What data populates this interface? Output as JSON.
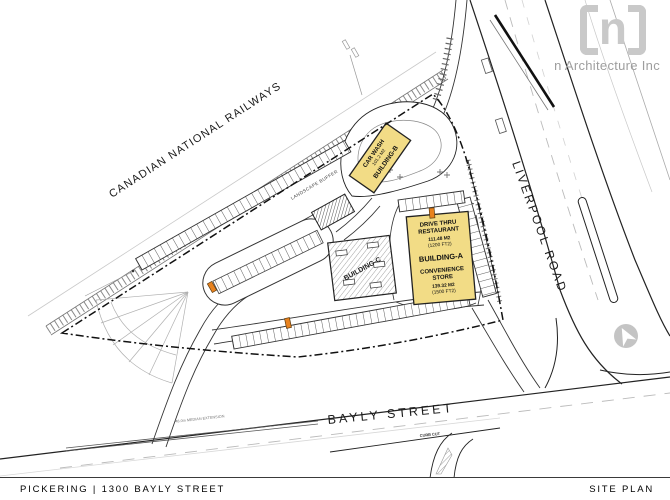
{
  "logo": {
    "mark_letter": "n",
    "company": "n Architecture Inc"
  },
  "title_block": {
    "project": "PICKERING | 1300 BAYLY STREET",
    "sheet": "SITE PLAN"
  },
  "map_labels": {
    "railway": "CANADIAN NATIONAL RAILWAYS",
    "landscape_buffer": "LANDSCAPE BUFFER",
    "liverpool_road": "LIVERPOOL ROAD",
    "bayly_street": "BAYLY STREET",
    "median_extension": "48.0m MEDIAN EXTENSION",
    "curb_cut": "CURB CUT"
  },
  "buildings": {
    "building_a": {
      "use_1": "DRIVE THRU",
      "use_1b": "RESTAURANT",
      "area_1": "111.48 M2",
      "area_1_ft": "(1200 FT2)",
      "name": "BUILDING-A",
      "use_2": "CONVENIENCE",
      "use_2b": "STORE",
      "area_2": "139.32 M2",
      "area_2_ft": "(1500 FT2)"
    },
    "building_b": {
      "use": "CAR WASH",
      "area": "101.2 M2",
      "name": "BUILDING-B"
    },
    "building_c": {
      "name": "BUILDING-C"
    }
  },
  "colors": {
    "building_fill": "#F2DC86",
    "building_stroke": "#222222",
    "marker_orange": "#E8821E",
    "logo_gray": "#C9C9C9",
    "line_dark": "#1F1F1F"
  }
}
